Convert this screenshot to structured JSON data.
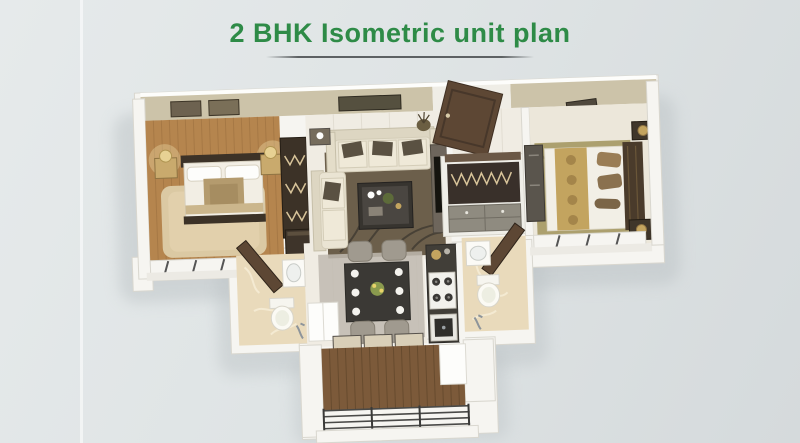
{
  "header": {
    "title": "2 BHK Isometric unit plan"
  },
  "figure": {
    "type": "isometric-floor-plan-illustration",
    "rooms": [
      "master-bedroom",
      "living-room",
      "entrance-foyer",
      "second-bedroom",
      "master-bathroom",
      "common-bathroom",
      "kitchen",
      "dining-area",
      "balcony"
    ]
  },
  "palette": {
    "bg_top": "#e6eaeb",
    "bg_bottom": "#d5dadc",
    "title_green": "#2e8b47",
    "divider": "#5d6163",
    "wall": "#f6f5f1",
    "wall_edge": "#d9d7cf",
    "wallpaper": "#ccc3a9",
    "wood": "#b5854e",
    "tile": "#f0ece3",
    "marble": "#e9dabb",
    "carpet": "#aca06e",
    "deck": "#7c5a3a",
    "dark_wood": "#3c3227",
    "door_brown": "#5d4734",
    "cream": "#eae4d3",
    "charcoal": "#413e38",
    "white": "#fdfdfb",
    "gold": "#c3a45f",
    "rug_dark": "#6c5f4b",
    "rug_beige": "#dbc9a3",
    "gray_chair": "#a09a8f",
    "shadow": "#bcc2c5"
  }
}
